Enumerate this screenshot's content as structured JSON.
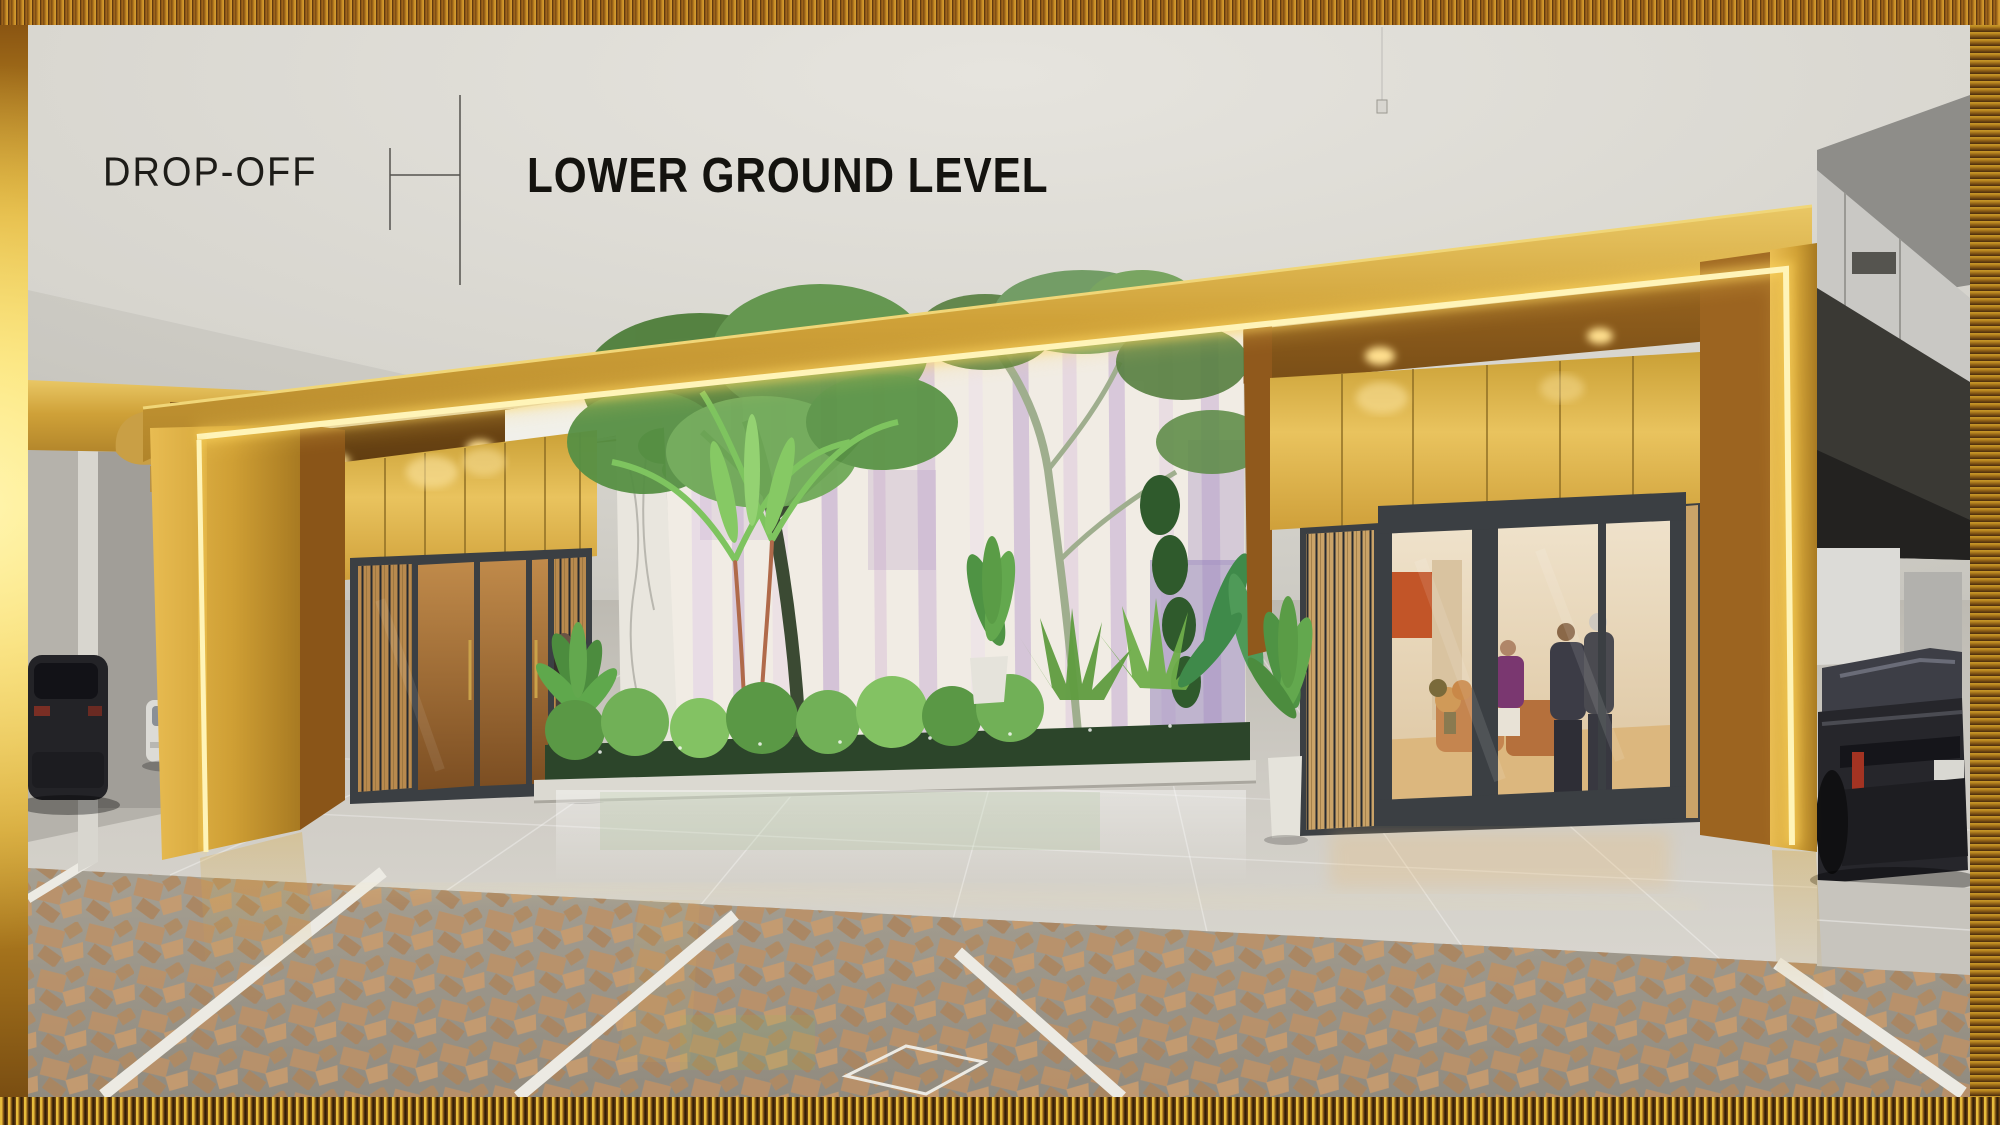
{
  "header": {
    "area_label": "DROP-OFF",
    "level_label": "LOWER GROUND LEVEL"
  },
  "scene": {
    "type": "architectural-rendering",
    "description": "3D rendering of a residential drop-off area at lower ground level: gold LED-lit entrance portal, vertical garden atrium with hanging flower-curtain wall and trees, dark-framed glass lobby doors with people inside, parked cars at both sides, glossy tile floor and brown paver parking apron with white bay lines, all inside a textured golden frame.",
    "elements": [
      "ceiling",
      "left-parking-garage",
      "right-parking-garage",
      "drop-off-floor",
      "paver-parking-apron",
      "gold-portal-frame",
      "led-strip-lighting",
      "portal-soffit",
      "white-canopy",
      "left-entrance",
      "garden-atrium",
      "flower-curtain-wall",
      "marble-side-wall",
      "right-entrance-lobby",
      "people-in-lobby",
      "potted-plants",
      "parked-car-dark-left",
      "parked-car-white-left",
      "parked-car-right",
      "hanging-wire",
      "divider-mark",
      "golden-frame-border"
    ]
  },
  "palette": {
    "frame_gold_bright": "#f6d344",
    "frame_gold_deep": "#6e4312",
    "band_gold": "#d2a53e",
    "panel_gold": "#ddb34c",
    "led_glow": "#fff4b8",
    "soffit_amber": "#7a4e16",
    "ceiling_gray": "#d8d6d0",
    "floor_gray": "#cbc8c1",
    "paver_tan": "#b9906a",
    "paver_base": "#9d978b",
    "marble_white": "#eae7df",
    "curtain_lavender": "#cbb8d6",
    "foliage_green": "#5f9c45",
    "door_frame": "#3b3f43",
    "interior_warm": "#e8d8c0",
    "text_dark": "#1d1c18"
  }
}
